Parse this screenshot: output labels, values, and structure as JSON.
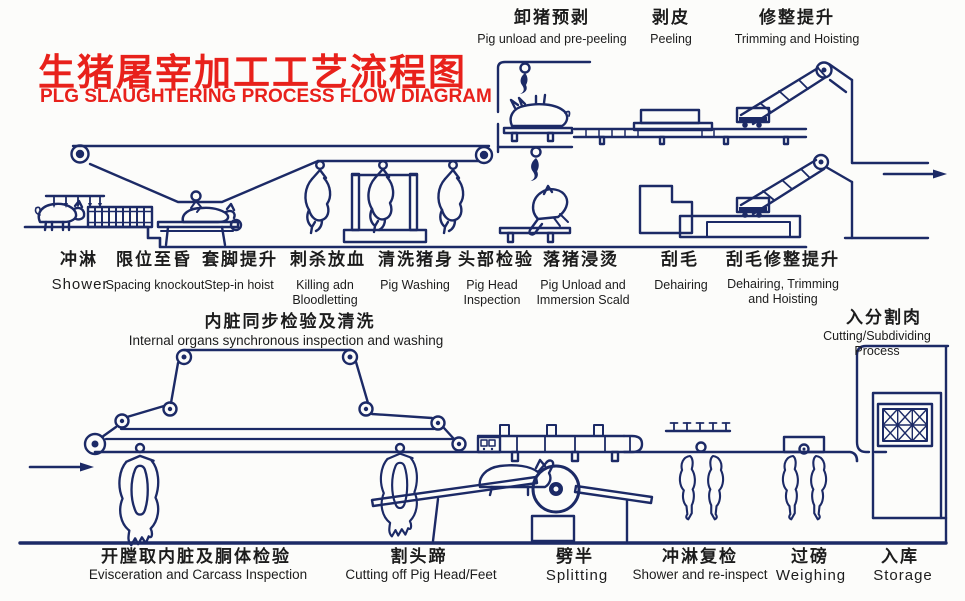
{
  "colors": {
    "line": "#1c2a66",
    "title": "#e8211b",
    "text": "#1c1c1c",
    "background": "#fcfcfa"
  },
  "title": {
    "zh": "生猪屠宰加工工艺流程图",
    "en": "PLG SLAUGHTERING PROCESS FLOW DIAGRAM"
  },
  "top_stations": [
    {
      "zh": "卸猪预剥",
      "en": "Pig unload and pre-peeling"
    },
    {
      "zh": "剥皮",
      "en": "Peeling"
    },
    {
      "zh": "修整提升",
      "en": "Trimming and Hoisting"
    }
  ],
  "mid_stations": [
    {
      "zh": "冲淋",
      "en": "Shower"
    },
    {
      "zh": "限位至昏",
      "en": "Spacing knockout"
    },
    {
      "zh": "套脚提升",
      "en": "Step-in hoist"
    },
    {
      "zh": "刺杀放血",
      "en": "Killing adn\nBloodletting"
    },
    {
      "zh": "清洗猪身",
      "en": "Pig Washing"
    },
    {
      "zh": "头部检验",
      "en": "Pig Head\nInspection"
    },
    {
      "zh": "落猪浸烫",
      "en": "Pig Unload and\nImmersion Scald"
    },
    {
      "zh": "刮毛",
      "en": "Dehairing"
    },
    {
      "zh": "刮毛修整提升",
      "en": "Dehairing, Trimming\nand Hoisting"
    }
  ],
  "inspection": {
    "zh": "内脏同步检验及清洗",
    "en": "Internal organs synchronous inspection and washing"
  },
  "subdividing": {
    "zh": "入分割肉",
    "en": "Cutting/Subdividing Process"
  },
  "bottom_stations": [
    {
      "zh": "开膛取内脏及胴体检验",
      "en": "Evisceration and Carcass Inspection"
    },
    {
      "zh": "割头蹄",
      "en": "Cutting off Pig Head/Feet"
    },
    {
      "zh": "劈半",
      "en": "Splitting"
    },
    {
      "zh": "冲淋复检",
      "en": "Shower and re-inspect"
    },
    {
      "zh": "过磅",
      "en": "Weighing"
    },
    {
      "zh": "入库",
      "en": "Storage"
    }
  ]
}
